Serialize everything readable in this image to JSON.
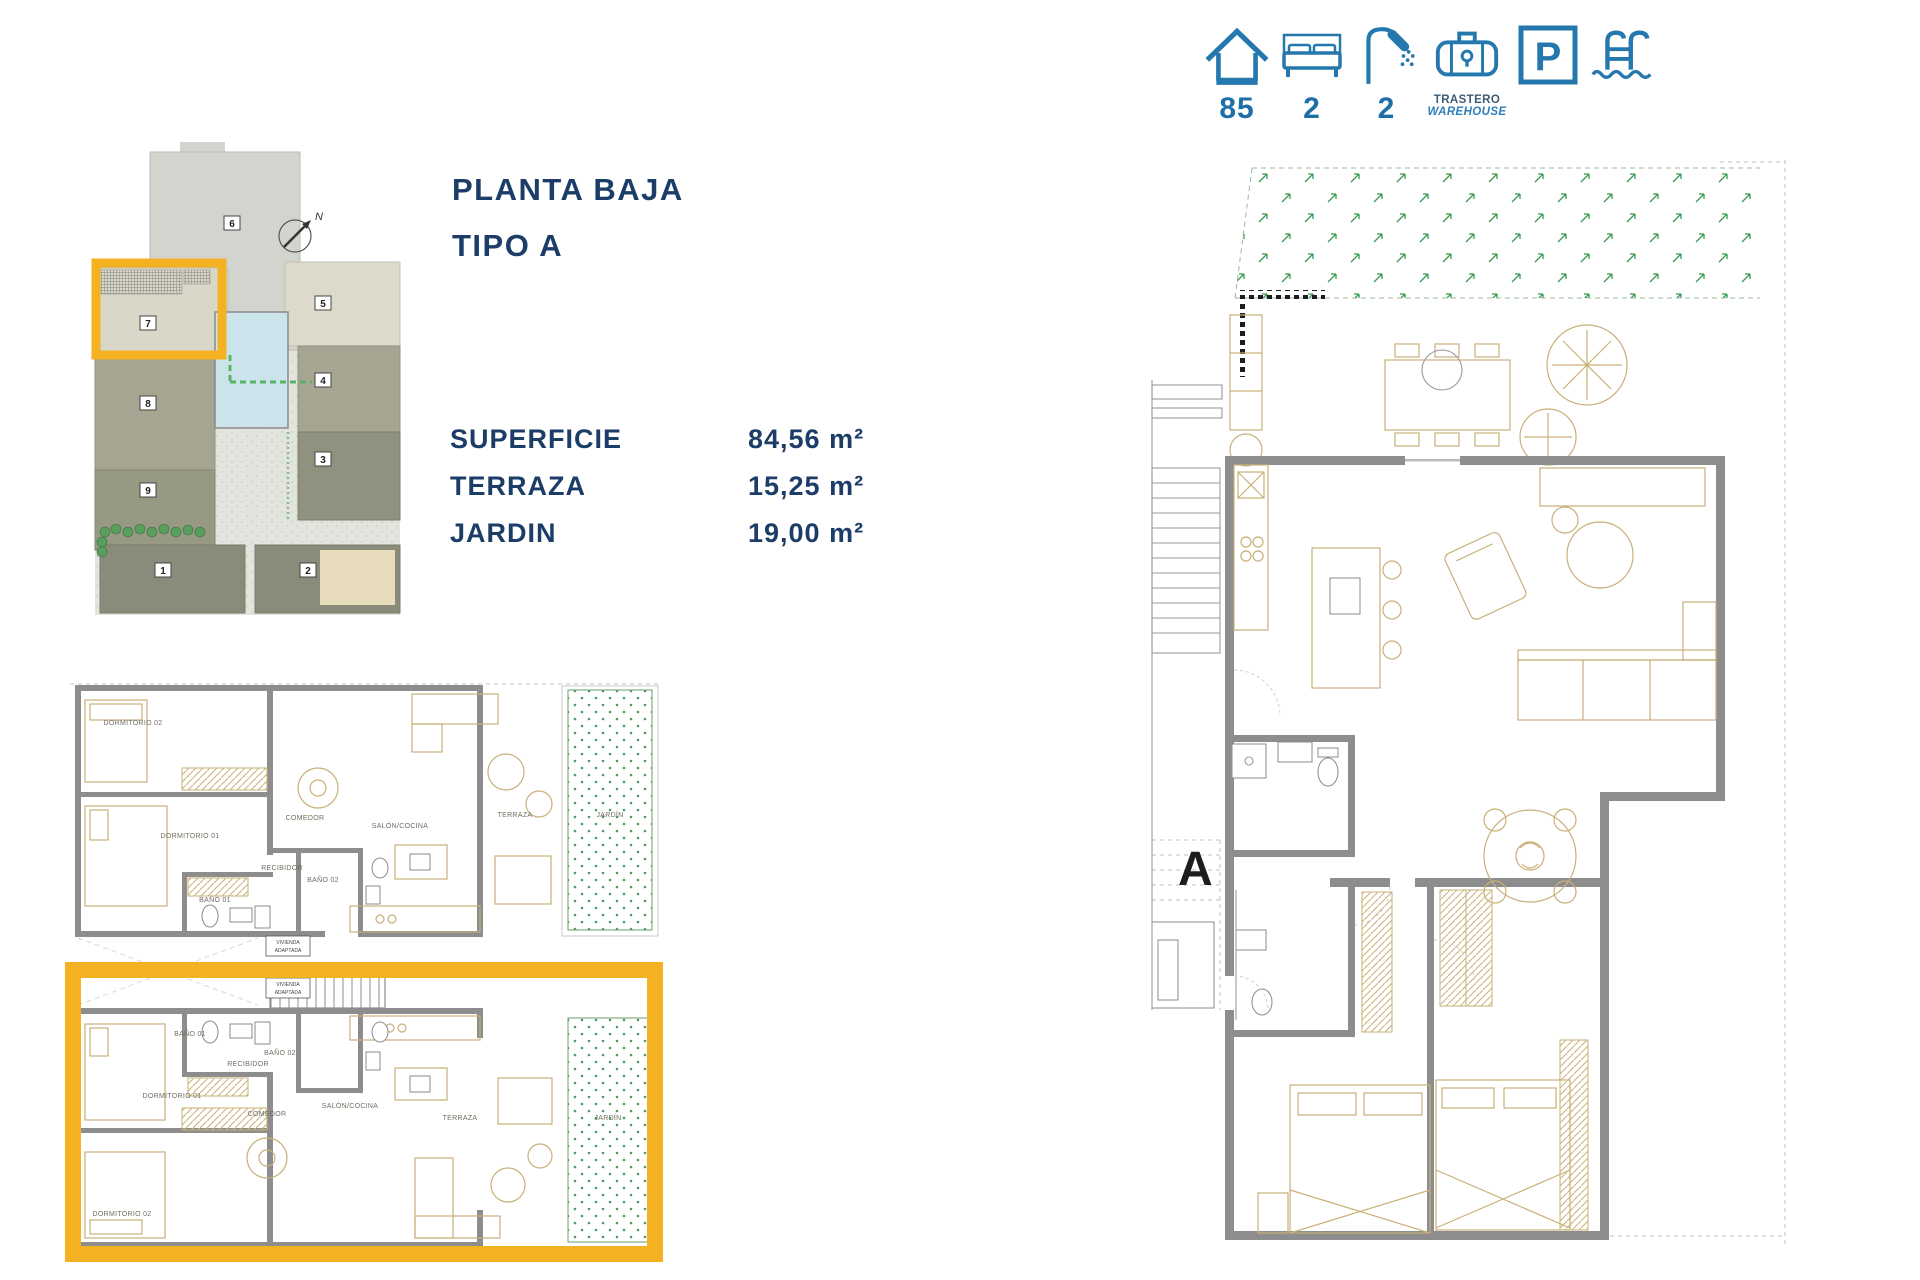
{
  "summary_bar": {
    "area": {
      "icon": "house-icon",
      "value": "85"
    },
    "bedrooms": {
      "icon": "bed-icon",
      "value": "2"
    },
    "bathrooms": {
      "icon": "shower-icon",
      "value": "2"
    },
    "storage": {
      "icon": "warehouse-icon",
      "line1": "TRASTERO",
      "line2": "WAREHOUSE"
    },
    "parking": {
      "icon": "parking-icon",
      "letter": "P"
    },
    "pool": {
      "icon": "pool-icon"
    }
  },
  "plan_info": {
    "title_line1": "PLANTA BAJA",
    "title_line2": "TIPO A",
    "rows": [
      {
        "label": "SUPERFICIE",
        "value": "84,56 m²"
      },
      {
        "label": "TERRAZA",
        "value": "15,25 m²"
      },
      {
        "label": "JARDIN",
        "value": "19,00 m²"
      }
    ]
  },
  "site_plan": {
    "north_label": "N",
    "highlighted": "7",
    "building_numbers": [
      "1",
      "2",
      "3",
      "4",
      "5",
      "6",
      "7",
      "8",
      "9"
    ]
  },
  "floor_plan_small": {
    "upper_unit": {
      "rooms": [
        "DORMITORIO 02",
        "DORMITORIO 01",
        "BAÑO 01",
        "RECIBIDOR",
        "COMEDOR",
        "BAÑO 02",
        "SALÓN/COCINA",
        "TERRAZA",
        "JARDÍN"
      ]
    },
    "lower_unit": {
      "rooms": [
        "BAÑO 01",
        "RECIBIDOR",
        "BAÑO 02",
        "DORMITORIO 01",
        "COMEDOR",
        "SALÓN/COCINA",
        "TERRAZA",
        "JARDÍN",
        "DORMITORIO 02"
      ]
    },
    "tags": [
      {
        "line1": "VIVIENDA",
        "line2": "ADAPTADA"
      },
      {
        "line1": "VIVIENDA",
        "line2": "ADAPTADA"
      }
    ]
  },
  "floor_plan_large": {
    "unit_label": "A"
  },
  "colors": {
    "accent_yellow": "#F4B223",
    "icon_blue": "#2478AE",
    "number_blue": "#1E6FA8",
    "navy": "#1C3D68",
    "wall_gray": "#8D8D8D",
    "furniture_tan": "#C9B077",
    "garden_green": "#4E9D62",
    "pool_blue": "#CBE3EA"
  }
}
